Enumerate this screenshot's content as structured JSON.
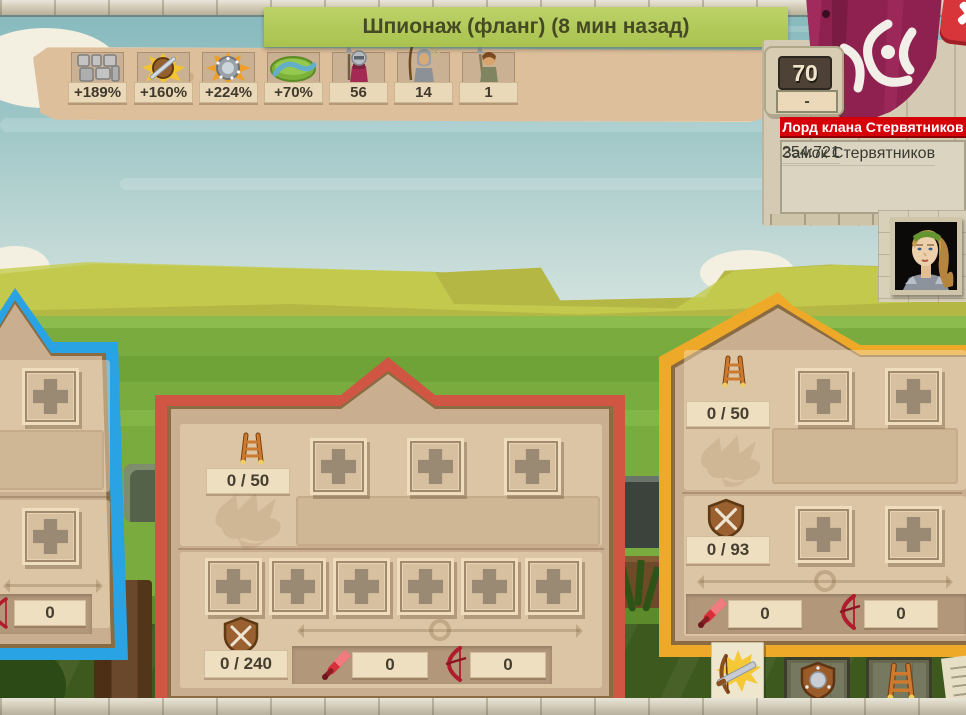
{
  "title_banner": {
    "text": "Шпионаж (фланг) (8 мин назад)"
  },
  "spy_stats": [
    {
      "icon": "castle-wall-icon",
      "value": "+189%"
    },
    {
      "icon": "gate-shield-icon",
      "value": "+160%"
    },
    {
      "icon": "boss-shield-icon",
      "value": "+224%"
    },
    {
      "icon": "moat-icon",
      "value": "+70%"
    },
    {
      "icon": "melee-soldier-icon",
      "value": "56"
    },
    {
      "icon": "archer-unit-icon",
      "value": "14"
    },
    {
      "icon": "spearman-unit-icon",
      "value": "1"
    }
  ],
  "defender": {
    "level": "70",
    "honor_value": "-",
    "rank_banner": "Лорд клана Стервятников",
    "castle_name": "Замок Стервятников",
    "coordinates": "254:721"
  },
  "flanks": {
    "left": {
      "bow_count": "0"
    },
    "front": {
      "ladder_capacity": "0 / 50",
      "courtyard_capacity": "0 / 240",
      "sword_count": "0",
      "bow_count": "0"
    },
    "right": {
      "ladder_capacity": "0 / 50",
      "courtyard_capacity": "0 / 93",
      "sword_count": "0",
      "bow_count": "0"
    }
  },
  "colors": {
    "left_flank_border": "#29a3e3",
    "front_flank_border": "#d15543",
    "right_flank_border": "#efa929",
    "title_banner_green": "#aec355",
    "rank_banner_red": "#d50008"
  }
}
